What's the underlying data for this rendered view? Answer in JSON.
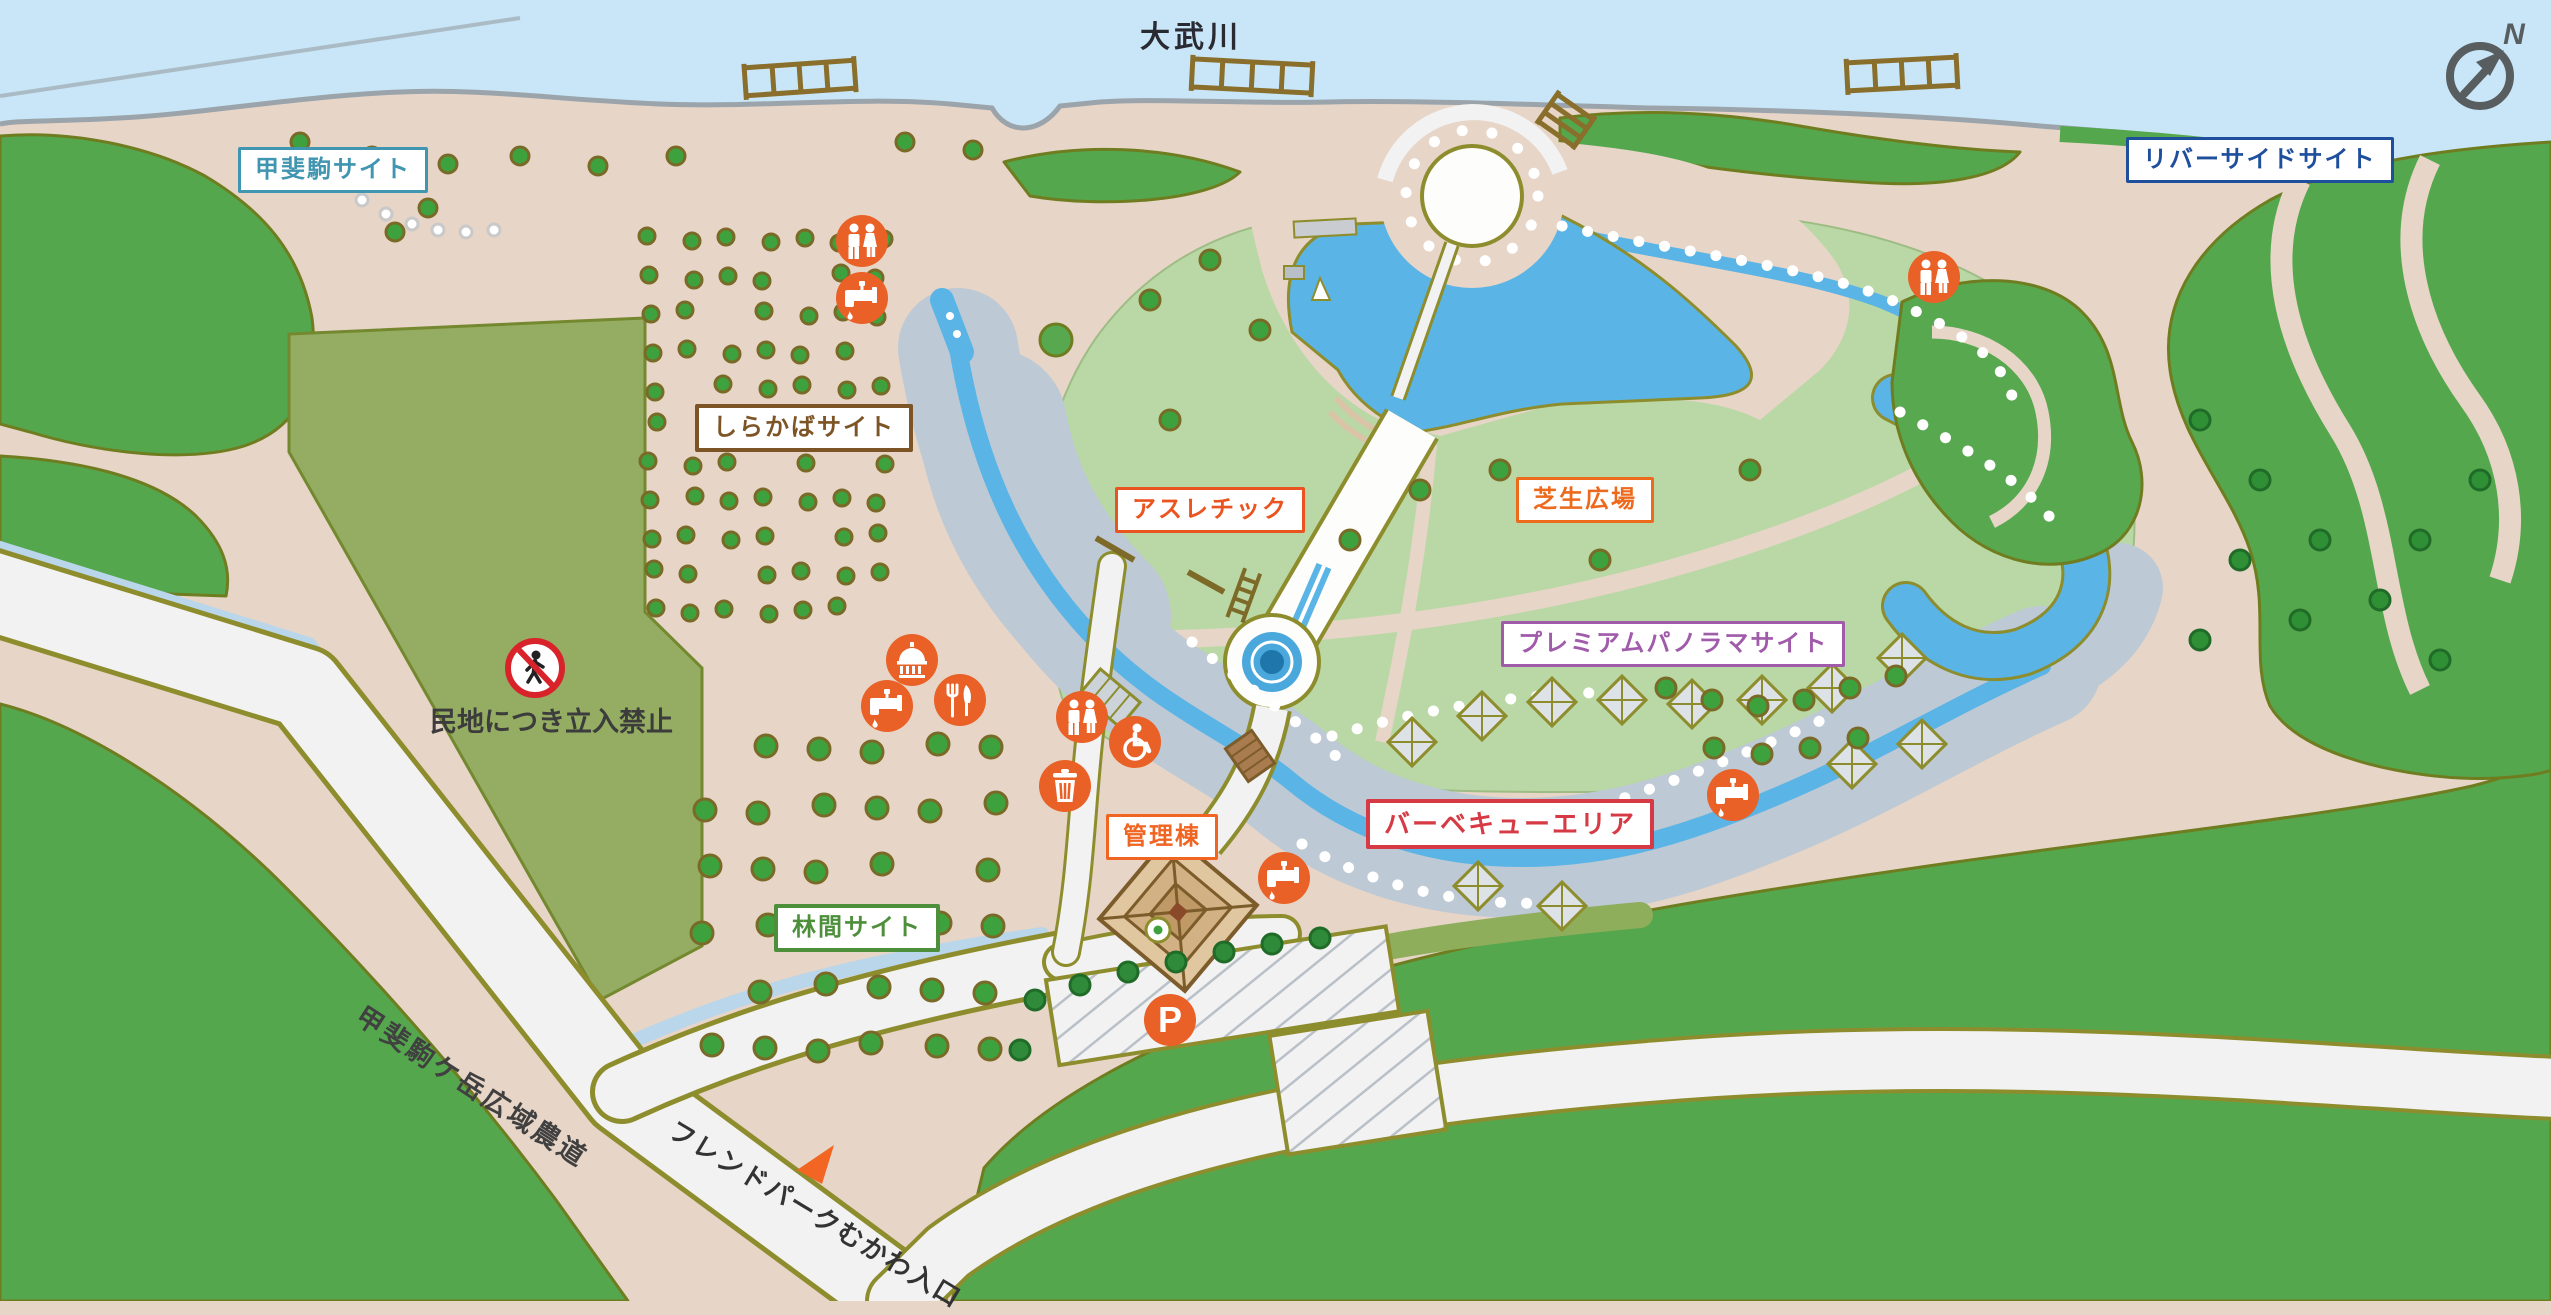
{
  "river_name": "大武川",
  "compass": {
    "n": "N"
  },
  "site_labels": {
    "kaikoma": {
      "text": "甲斐駒サイト",
      "color": "#4095b0"
    },
    "riverside": {
      "text": "リバーサイドサイト",
      "color": "#1e4f9c"
    },
    "shirakaba": {
      "text": "しらかばサイト",
      "color": "#7d5426"
    },
    "athletic": {
      "text": "アスレチック",
      "color": "#ea5420"
    },
    "shibafu": {
      "text": "芝生広場",
      "color": "#ed6a1c"
    },
    "premium": {
      "text": "プレミアムパノラマサイト",
      "color": "#a05caa"
    },
    "bbq": {
      "text": "バーベキューエリア",
      "color": "#d63a44"
    },
    "kanri": {
      "text": "管理棟",
      "color": "#f06522"
    },
    "rinkan": {
      "text": "林間サイト",
      "color": "#4e8f3c"
    }
  },
  "notes": {
    "no_entry": "民地につき立入禁止",
    "road": "甲斐駒ケ岳広域農道",
    "entrance": "フレンドパークむかわ入口"
  },
  "markers": {
    "parking": "P"
  },
  "icon_types": [
    "restroom-icon",
    "accessible-restroom-icon",
    "water-tap-icon",
    "restaurant-icon",
    "trash-icon",
    "gazebo-icon",
    "parking-icon",
    "no-entry-walking-icon",
    "compass-icon",
    "entrance-arrow-icon"
  ],
  "palette": {
    "river": "#c8e6f7",
    "land": "#e7d5c7",
    "forest": "#55a74d",
    "lawn": "#bad8a5",
    "private_field": "#94ad62",
    "water": "#5ab4e6",
    "gravel": "#bdc9d4",
    "road": "#f2f2f2",
    "road_edge": "#8e8d2d",
    "icon_orange": "#e96127",
    "tree": "#3da23d",
    "no_entry_red": "#d8232a"
  }
}
